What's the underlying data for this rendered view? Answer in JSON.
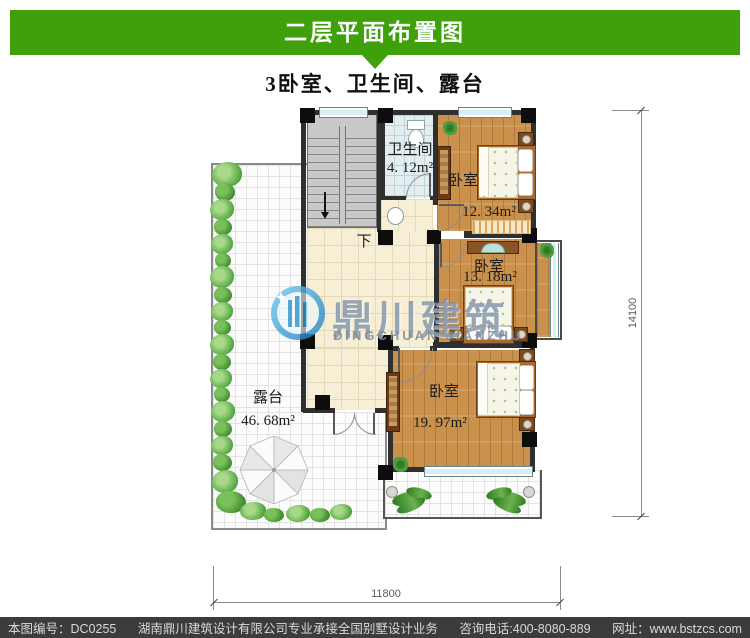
{
  "header": {
    "title": "二层平面布置图",
    "subtitle": "3卧室、卫生间、露台"
  },
  "plan": {
    "rooms": {
      "bathroom": {
        "name": "卫生间",
        "area": "4. 12m²"
      },
      "bedroom_top": {
        "name": "卧室",
        "area": "12. 34m²"
      },
      "bedroom_mid": {
        "name": "卧室",
        "area": "13. 18m²"
      },
      "bedroom_bottom": {
        "name": "卧室",
        "area": "19. 97m²"
      },
      "terrace": {
        "name": "露台",
        "area": "46. 68m²"
      }
    },
    "stair_down_label": "下",
    "dimensions": {
      "bottom": "11800",
      "right": "14100"
    }
  },
  "watermark": {
    "name_cn": "鼎川建筑",
    "name_en": "DINGCHUAN JIANZHU"
  },
  "footer": {
    "drawing_no": "本图编号：DC0255",
    "company": "湖南鼎川建筑设计有限公司专业承接全国别墅设计业务",
    "phone": "咨询电话:400-8080-889",
    "website": "网址：www.bstzcs.com"
  },
  "colors": {
    "banner_green": "#3fa00c",
    "footer_bg": "#3c3c3c",
    "wood_floor": "#c9914c",
    "hall_tile": "#f6efd6",
    "bath_tile": "#e4eef0",
    "terrace_tile": "#fcfcfc",
    "stair_gray": "#c9c9c9",
    "wall_dark": "#2f2f2f",
    "window_blue": "#d9edf3",
    "plant_green": "#3e8c2e",
    "watermark_blue": "#2b93cc"
  }
}
